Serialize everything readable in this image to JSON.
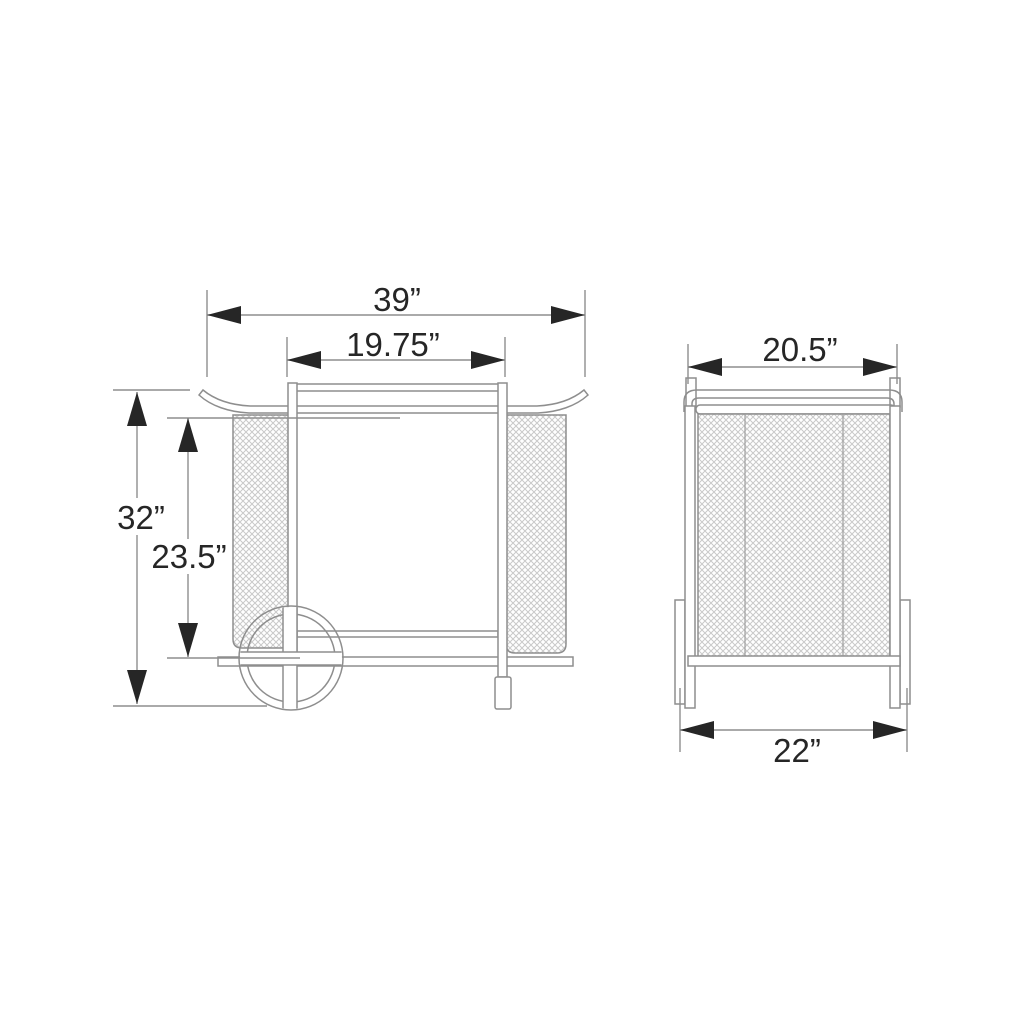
{
  "drawing": {
    "type": "furniture-dimension-drawing",
    "side_view": {
      "overall_width": "39”",
      "top_inner_width": "19.75”",
      "overall_height": "32”",
      "undershelf_height": "23.5”"
    },
    "end_view": {
      "top_width": "20.5”",
      "base_width": "22”"
    },
    "colors": {
      "line": "#8e8e8e",
      "ink": "#262626",
      "mesh": "#c9c9c9",
      "background": "#ffffff"
    }
  }
}
